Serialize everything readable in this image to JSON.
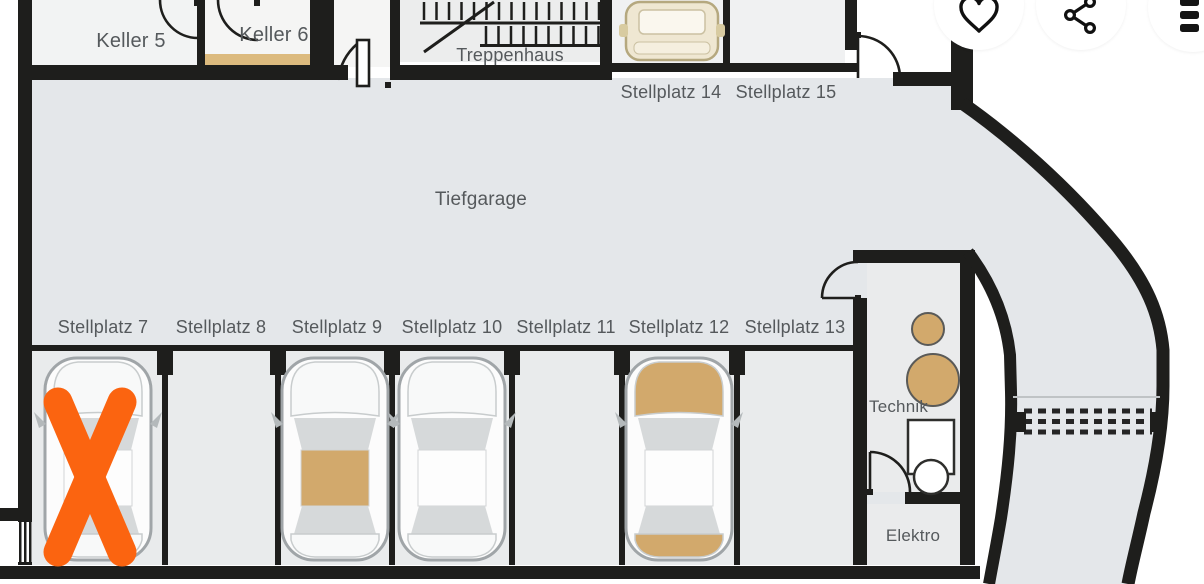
{
  "toolbar": {
    "buttons": [
      {
        "icon": "heart-icon",
        "name": "favorite"
      },
      {
        "icon": "share-icon",
        "name": "share"
      },
      {
        "icon": "kebab-menu-icon",
        "name": "more-options"
      }
    ]
  },
  "floorplan": {
    "area_label": "Tiefgarage",
    "stairwell_label": "Treppenhaus",
    "rooms": {
      "keller5": "Keller 5",
      "keller6": "Keller 6",
      "technik": "Technik",
      "elektro": "Elektro"
    },
    "top_stalls": [
      {
        "id": 14,
        "label": "Stellplatz 14",
        "occupied": true,
        "car_style": "front"
      },
      {
        "id": 15,
        "label": "Stellplatz 15",
        "occupied": false
      }
    ],
    "bottom_stalls": [
      {
        "id": 7,
        "label": "Stellplatz 7",
        "occupied": true,
        "car_style": "plain",
        "marked": true
      },
      {
        "id": 8,
        "label": "Stellplatz 8",
        "occupied": false
      },
      {
        "id": 9,
        "label": "Stellplatz 9",
        "occupied": true,
        "car_style": "tan-roof"
      },
      {
        "id": 10,
        "label": "Stellplatz 10",
        "occupied": true,
        "car_style": "plain"
      },
      {
        "id": 11,
        "label": "Stellplatz 11",
        "occupied": false
      },
      {
        "id": 12,
        "label": "Stellplatz 12",
        "occupied": true,
        "car_style": "tan-ends"
      },
      {
        "id": 13,
        "label": "Stellplatz 13",
        "occupied": false
      }
    ],
    "colors": {
      "marker_orange": "#fb6410",
      "tan": "#d2a96c",
      "wall": "#1e1e1c",
      "floor": "#e4e7ea"
    }
  }
}
